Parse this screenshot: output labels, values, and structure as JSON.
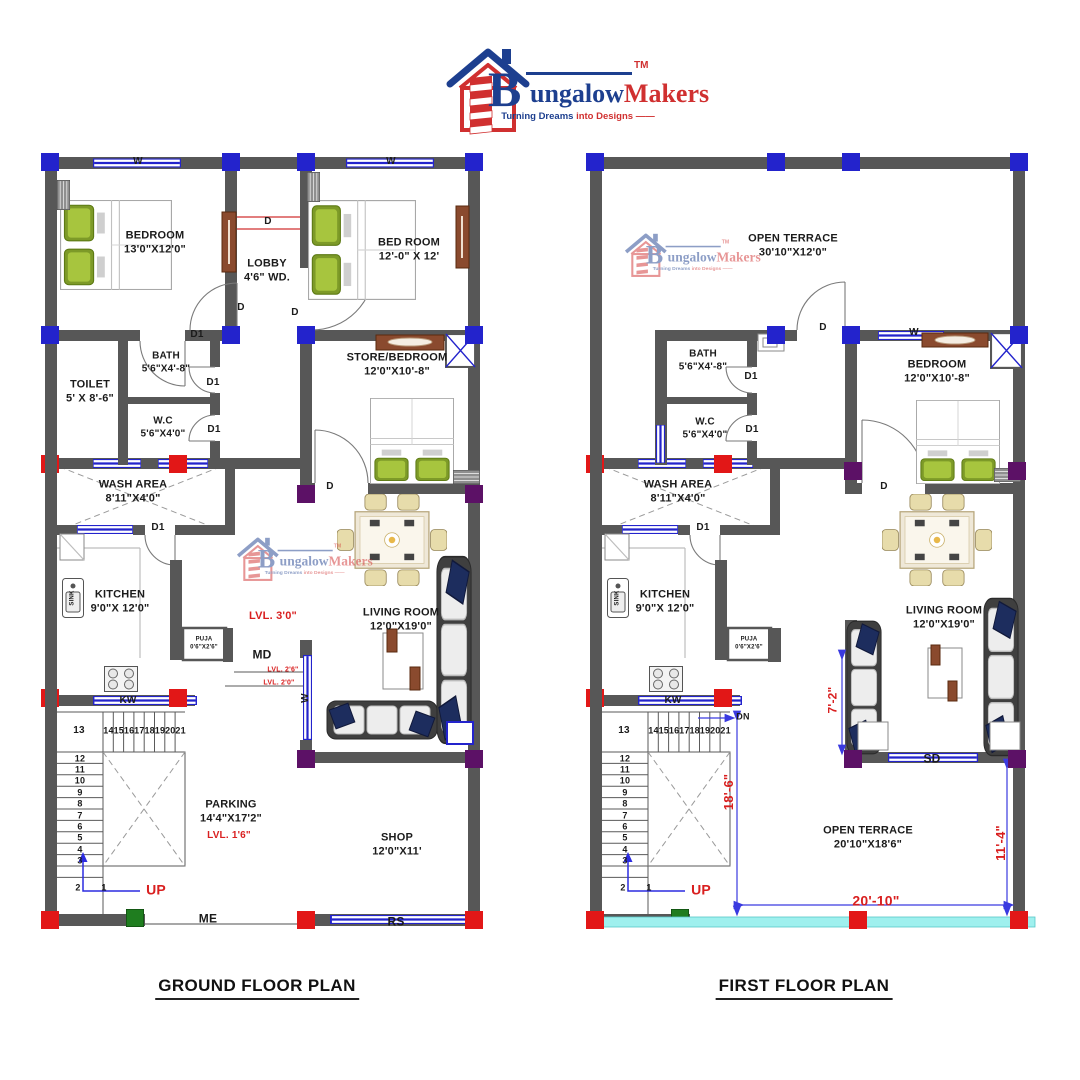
{
  "brand": {
    "initial": "B",
    "name_blue": "ungalow",
    "name_red": "Makers",
    "tm": "TM",
    "tagline_blue": "Turning Dreams ",
    "tagline_red": "into Designs ——"
  },
  "titles": {
    "ground": "GROUND FLOOR PLAN",
    "first": "FIRST FLOOR PLAN"
  },
  "colors": {
    "wall": "#575757",
    "blue": "#2323cc",
    "red": "#e21717",
    "purple": "#5c1166",
    "green": "#1f7d1f",
    "dim_red": "#d91f1f",
    "cyan": "#9ff0ee",
    "door_brown": "#8a4a2e",
    "pillow_green": "#7d9a28",
    "navy": "#1d2d5e",
    "chair_tan": "#e7dcab",
    "logo_blue": "#1d3f8f",
    "logo_red": "#d03030"
  },
  "stairs": {
    "landing": "13",
    "top_run": [
      "14",
      "15",
      "16",
      "17",
      "18",
      "19",
      "20",
      "21"
    ],
    "side_run": [
      "12",
      "11",
      "10",
      "9",
      "8",
      "7",
      "6",
      "5",
      "4",
      "3"
    ],
    "bottom": [
      "2",
      "1"
    ]
  },
  "ground": {
    "labels": [
      {
        "t": "W",
        "x": 138,
        "y": 162,
        "fs": 10
      },
      {
        "t": "W",
        "x": 391,
        "y": 162,
        "fs": 10
      },
      {
        "t": "BEDROOM\n13'0\"X12'0\"",
        "x": 155,
        "y": 243,
        "n": "ground-bedroom-label"
      },
      {
        "t": "D",
        "x": 268,
        "y": 222,
        "fs": 10
      },
      {
        "t": "LOBBY\n4'6\" WD.",
        "x": 267,
        "y": 271,
        "n": "ground-lobby-label"
      },
      {
        "t": "BED ROOM\n12'-0\" X 12'",
        "x": 409,
        "y": 250,
        "n": "ground-bedroom2-label"
      },
      {
        "t": "D",
        "x": 241,
        "y": 308,
        "fs": 10
      },
      {
        "t": "D",
        "x": 295,
        "y": 313,
        "fs": 10
      },
      {
        "t": "D1",
        "x": 197,
        "y": 335,
        "fs": 10
      },
      {
        "t": "BATH\n5'6\"X4'-8\"",
        "x": 166,
        "y": 363,
        "fs": 10,
        "n": "ground-bath-label"
      },
      {
        "t": "D1",
        "x": 213,
        "y": 383,
        "fs": 10
      },
      {
        "t": "TOILET\n5' X 8'-6\"",
        "x": 90,
        "y": 392,
        "n": "ground-toilet-label"
      },
      {
        "t": "W.C\n5'6\"X4'0\"",
        "x": 163,
        "y": 428,
        "fs": 10,
        "n": "ground-wc-label"
      },
      {
        "t": "D1",
        "x": 214,
        "y": 430,
        "fs": 10
      },
      {
        "t": "STORE/BEDROOM\n12'0\"X10'-8\"",
        "x": 397,
        "y": 365,
        "n": "ground-store-label"
      },
      {
        "t": "D",
        "x": 330,
        "y": 487,
        "fs": 10
      },
      {
        "t": "WASH AREA\n8'11\"X4'0\"",
        "x": 133,
        "y": 492,
        "n": "ground-wash-label"
      },
      {
        "t": "D1",
        "x": 158,
        "y": 528,
        "fs": 10
      },
      {
        "t": "KITCHEN\n9'0\"X 12'0\"",
        "x": 120,
        "y": 602,
        "n": "ground-kitchen-label"
      },
      {
        "t": "SINK",
        "x": 73,
        "y": 598,
        "fs": 6,
        "rot": -90
      },
      {
        "t": "LVL. 3'0\"",
        "x": 273,
        "y": 617,
        "c": "red"
      },
      {
        "t": "PUJA\n0'6\"X2'6\"",
        "x": 204,
        "y": 644,
        "fs": 6
      },
      {
        "t": "MD",
        "x": 262,
        "y": 655,
        "fs": 12
      },
      {
        "t": "LVL. 2'6\"",
        "x": 283,
        "y": 671,
        "fs": 7,
        "c": "red"
      },
      {
        "t": "LVL. 2'0\"",
        "x": 279,
        "y": 684,
        "fs": 7,
        "c": "red"
      },
      {
        "t": "LIVING ROOM\n12'0\"X19'0\"",
        "x": 401,
        "y": 620,
        "n": "ground-living-label"
      },
      {
        "t": "W",
        "x": 306,
        "y": 698,
        "fs": 10,
        "rot": -90
      },
      {
        "t": "KW",
        "x": 128,
        "y": 701,
        "fs": 10
      },
      {
        "t": "PARKING\n14'4\"X17'2\"",
        "x": 231,
        "y": 812,
        "n": "ground-parking-label"
      },
      {
        "t": "LVL. 1'6\"",
        "x": 229,
        "y": 836,
        "fs": 10,
        "c": "red"
      },
      {
        "t": "UP",
        "x": 156,
        "y": 890,
        "fs": 14,
        "c": "red"
      },
      {
        "t": "ME",
        "x": 208,
        "y": 919,
        "fs": 12
      },
      {
        "t": "SHOP\n12'0\"X11'",
        "x": 397,
        "y": 845,
        "n": "ground-shop-label"
      },
      {
        "t": "RS",
        "x": 396,
        "y": 922,
        "fs": 12
      }
    ]
  },
  "first": {
    "labels": [
      {
        "t": "OPEN TERRACE\n30'10\"X12'0\"",
        "x": 793,
        "y": 246,
        "n": "first-terrace-top-label"
      },
      {
        "t": "D",
        "x": 823,
        "y": 328,
        "fs": 10
      },
      {
        "t": "W",
        "x": 914,
        "y": 333,
        "fs": 10
      },
      {
        "t": "BATH\n5'6\"X4'-8\"",
        "x": 703,
        "y": 361,
        "fs": 10,
        "n": "first-bath-label"
      },
      {
        "t": "D1",
        "x": 751,
        "y": 377,
        "fs": 10
      },
      {
        "t": "W.C\n5'6\"X4'0\"",
        "x": 705,
        "y": 429,
        "fs": 10,
        "n": "first-wc-label"
      },
      {
        "t": "D1",
        "x": 752,
        "y": 430,
        "fs": 10
      },
      {
        "t": "BEDROOM\n12'0\"X10'-8\"",
        "x": 937,
        "y": 372,
        "n": "first-bedroom-label"
      },
      {
        "t": "D",
        "x": 884,
        "y": 487,
        "fs": 10
      },
      {
        "t": "WASH AREA\n8'11\"X4'0\"",
        "x": 678,
        "y": 492,
        "n": "first-wash-label"
      },
      {
        "t": "D1",
        "x": 703,
        "y": 528,
        "fs": 10
      },
      {
        "t": "KITCHEN\n9'0\"X 12'0\"",
        "x": 665,
        "y": 602,
        "n": "first-kitchen-label"
      },
      {
        "t": "SINK",
        "x": 618,
        "y": 598,
        "fs": 6,
        "rot": -90
      },
      {
        "t": "PUJA\n0'6\"X2'6\"",
        "x": 749,
        "y": 644,
        "fs": 6
      },
      {
        "t": "LIVING ROOM\n12'0\"X19'0\"",
        "x": 944,
        "y": 618,
        "n": "first-living-label"
      },
      {
        "t": "KW",
        "x": 673,
        "y": 701,
        "fs": 10
      },
      {
        "t": "DN",
        "x": 743,
        "y": 717,
        "fs": 9
      },
      {
        "t": "7'-2\"",
        "x": 833,
        "y": 700,
        "fs": 12,
        "c": "red",
        "rot": -90
      },
      {
        "t": "18'-6\"",
        "x": 729,
        "y": 792,
        "fs": 13,
        "c": "red",
        "rot": -90
      },
      {
        "t": "OPEN TERRACE\n20'10\"X18'6\"",
        "x": 868,
        "y": 838,
        "n": "first-terrace-bottom-label"
      },
      {
        "t": "11'-4\"",
        "x": 1001,
        "y": 843,
        "fs": 13,
        "c": "red",
        "rot": -90
      },
      {
        "t": "20'-10\"",
        "x": 876,
        "y": 901,
        "fs": 14,
        "c": "red"
      },
      {
        "t": "UP",
        "x": 701,
        "y": 890,
        "fs": 14,
        "c": "red"
      },
      {
        "t": "SD",
        "x": 932,
        "y": 759,
        "fs": 12
      }
    ]
  }
}
